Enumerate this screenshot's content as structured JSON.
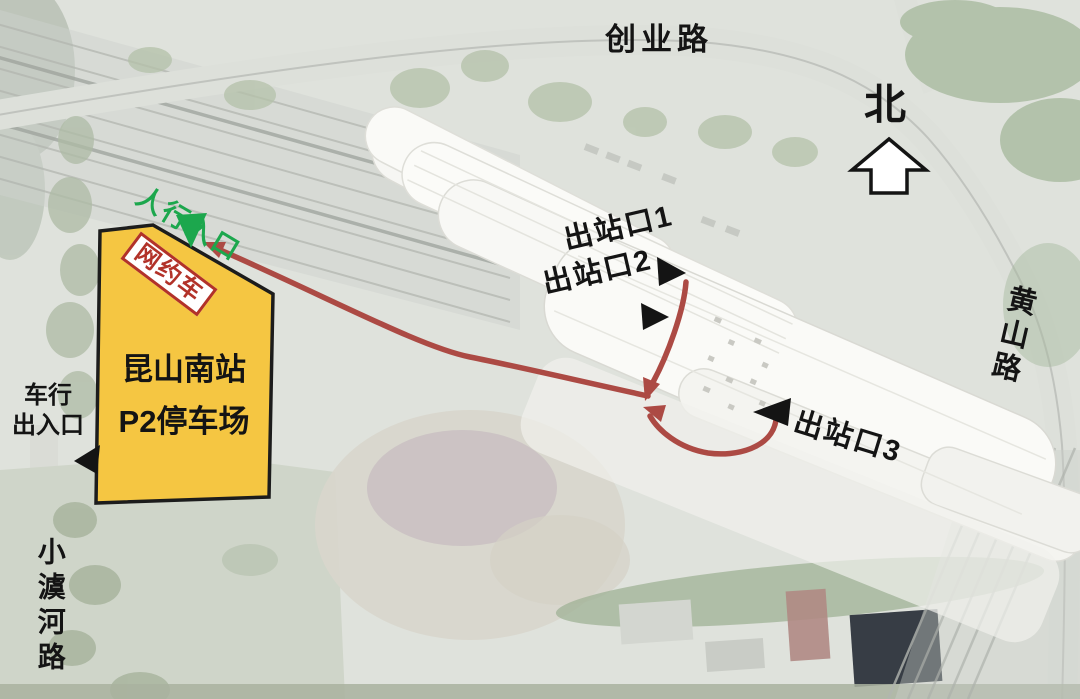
{
  "roads": {
    "chuangye": "创业路",
    "huangshan": "黄山路",
    "xiaoyuhe": "小澞河路"
  },
  "compass": {
    "north_label": "北"
  },
  "parking": {
    "name_line1": "昆山南站",
    "name_line2": "P2停车场",
    "ride_hailing_tag": "网约车",
    "fill_color": "#F5C642",
    "tag_color": "#B23229"
  },
  "entrances": {
    "pedestrian_label": "人行入口",
    "pedestrian_color": "#1CA74D",
    "vehicle_lines": [
      "车行",
      "出入口"
    ]
  },
  "exits": {
    "exit1_label": "出站口1",
    "exit2_label": "出站口2",
    "exit3_label": "出站口3",
    "marker_color": "#141414"
  },
  "route": {
    "color": "#AC4A44"
  }
}
